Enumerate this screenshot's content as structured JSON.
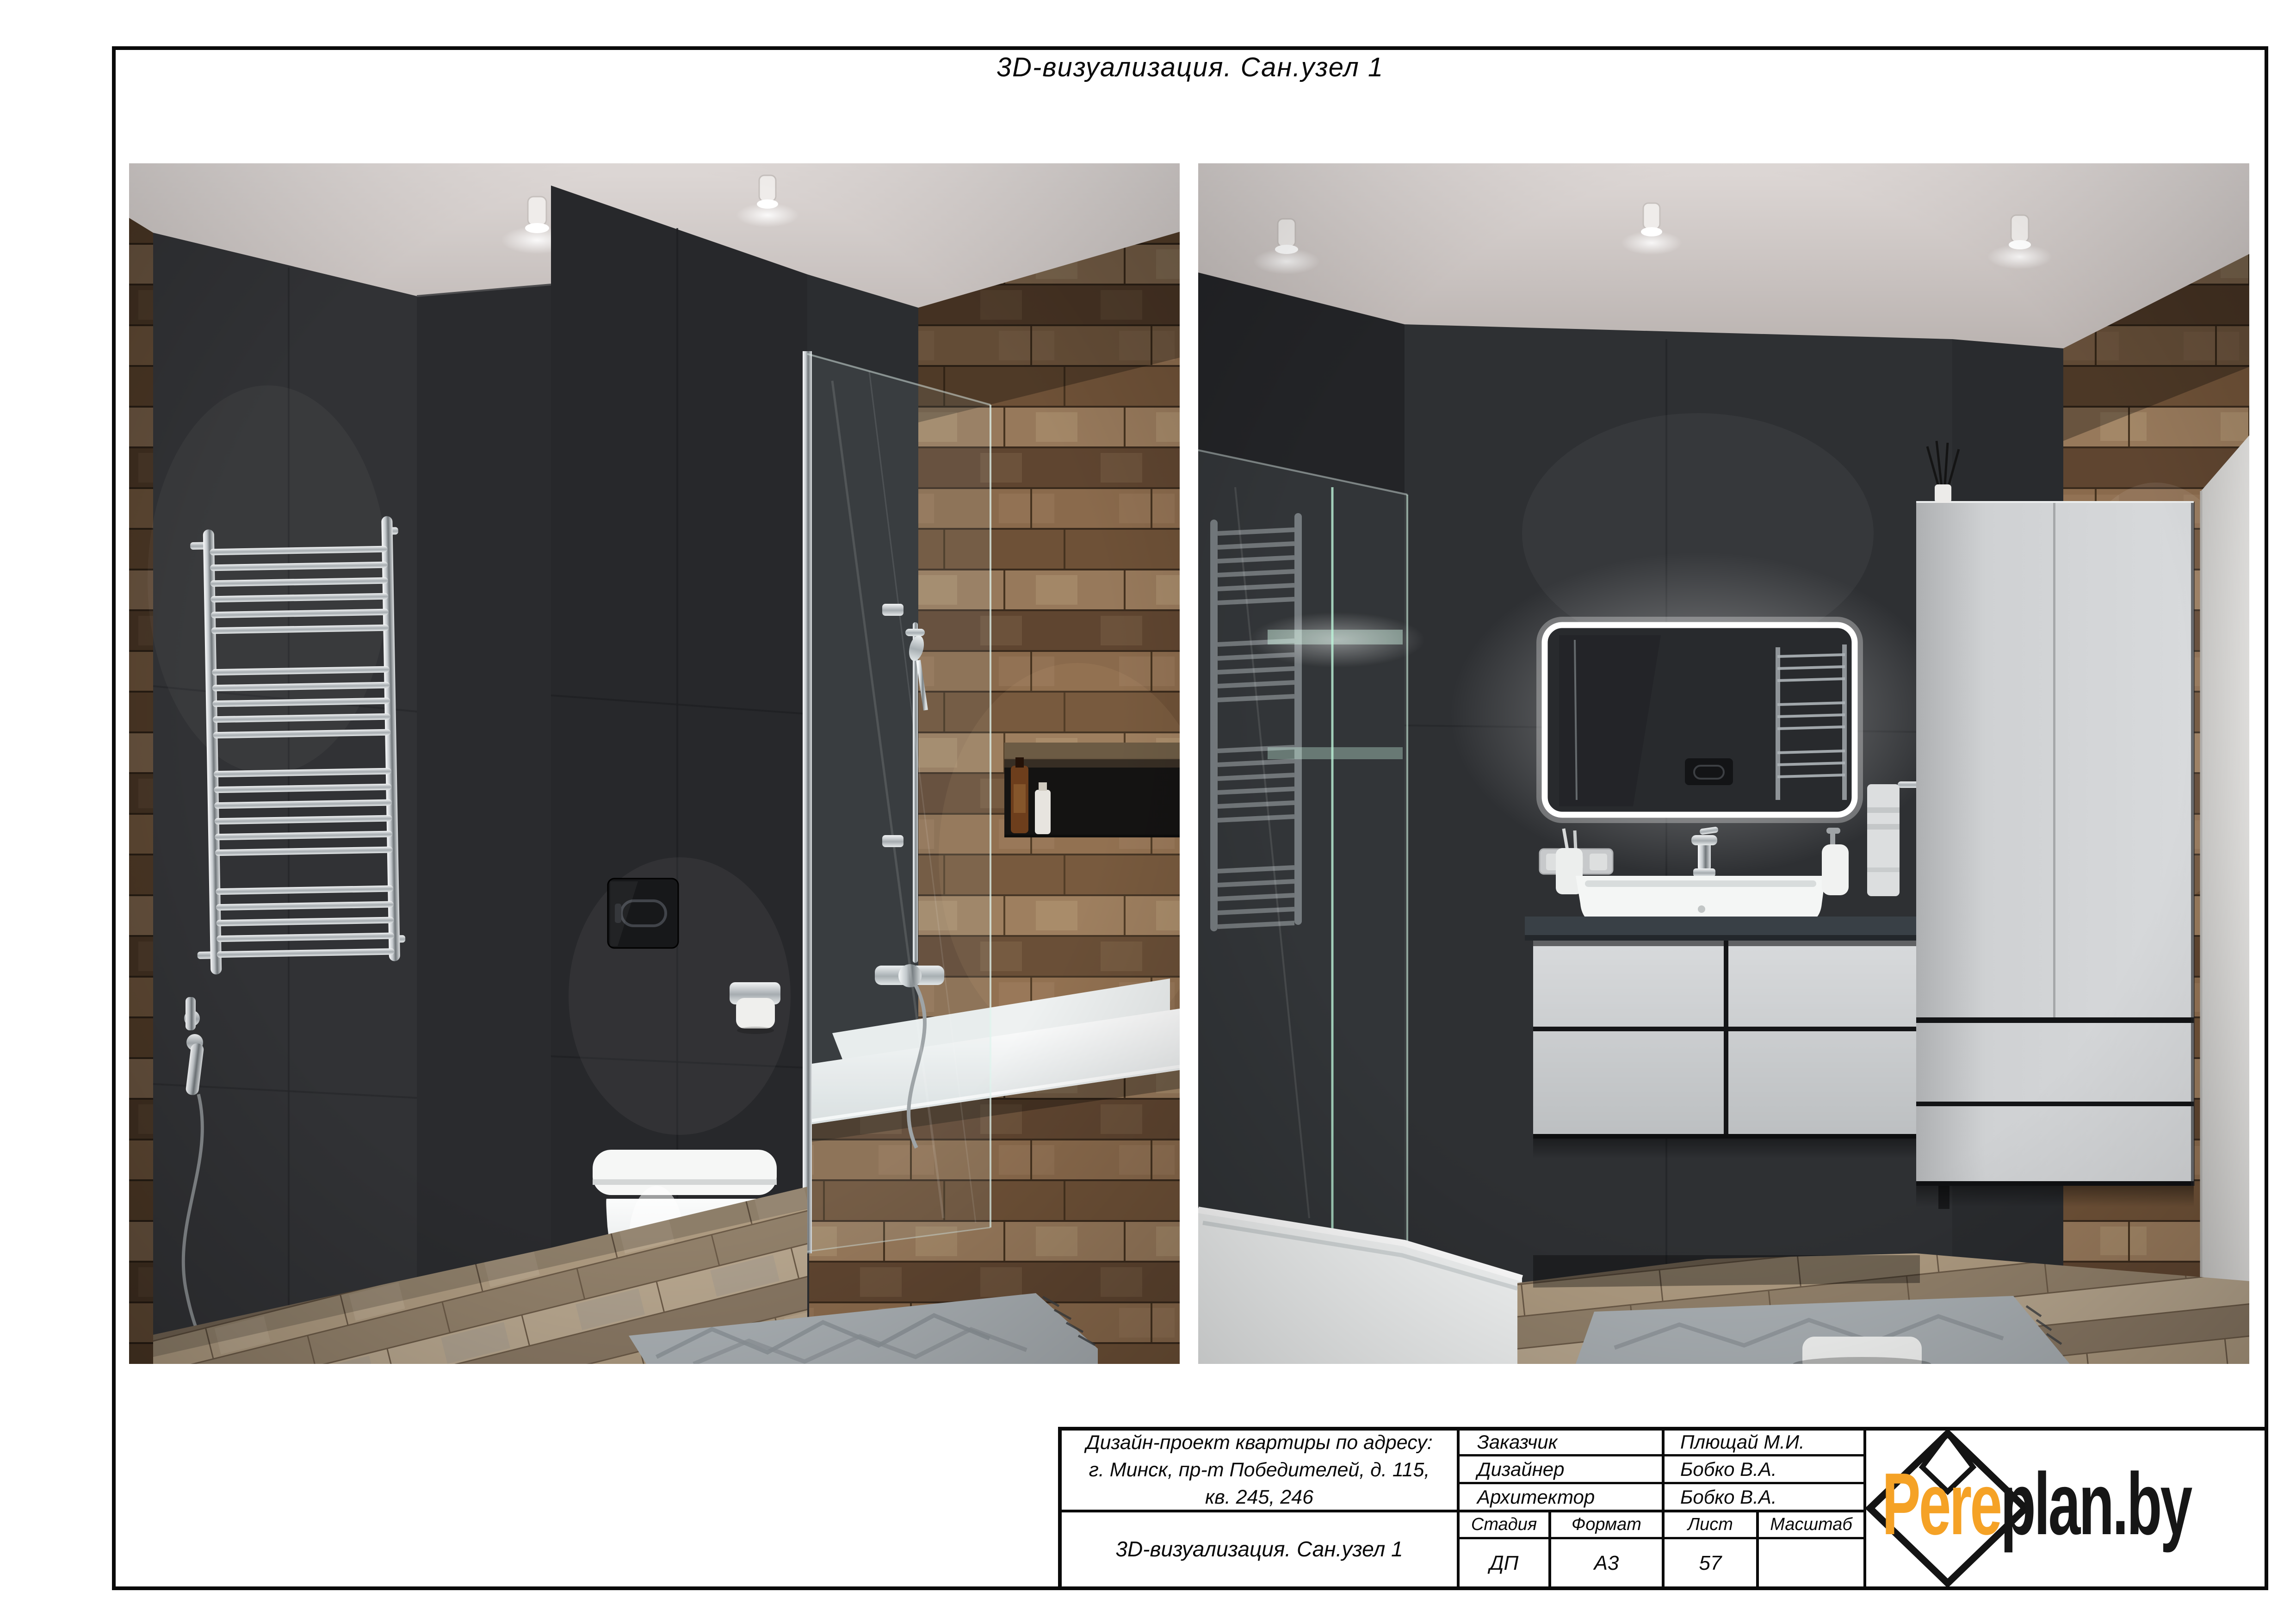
{
  "page": {
    "sheet_header": "3D-визуализация. Сан.узел 1"
  },
  "title_block": {
    "project_address": {
      "line1": "Дизайн-проект квартиры по адресу:",
      "line2": "г. Минск, пр-т Победителей, д. 115,",
      "line3": "кв. 245, 246"
    },
    "drawing_title": "3D-визуализация. Сан.узел 1",
    "people": [
      {
        "role": "Заказчик",
        "name": "Плющай М.И."
      },
      {
        "role": "Дизайнер",
        "name": "Бобко В.А."
      },
      {
        "role": "Архитектор",
        "name": "Бобко В.А."
      }
    ],
    "meta": {
      "headers": [
        "Стадия",
        "Формат",
        "Лист",
        "Масштаб"
      ],
      "values": [
        "ДП",
        "А3",
        "57",
        ""
      ]
    },
    "logo": {
      "text_orange": "Pere",
      "text_black": "plan.by",
      "orange_hex": "#F5A226",
      "black_hex": "#161616"
    }
  },
  "colors": {
    "page_background": "#ffffff",
    "drafting_line": "#0a0a0a",
    "dark_tile_wall": "#2c2d30",
    "wood_tile": "#7b5c40",
    "fixture_white": "#f2f4f4"
  }
}
